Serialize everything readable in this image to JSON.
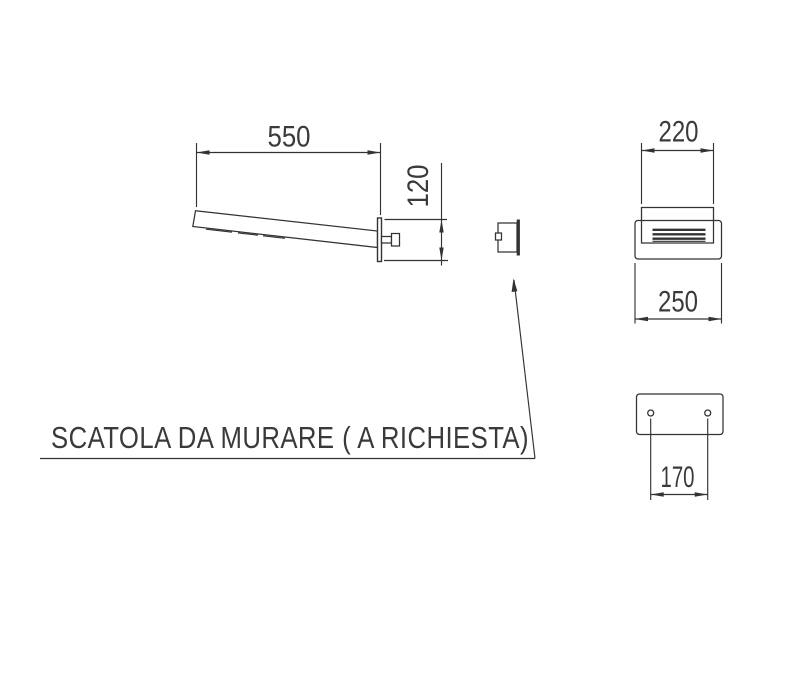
{
  "drawing": {
    "caption": "SCATOLA DA MURARE ( A RICHIESTA)",
    "dimensions": {
      "arm_length": "550",
      "backplate_height": "120",
      "head_width": "220",
      "body_width": "250",
      "hole_spacing": "170"
    },
    "colors": {
      "line": "#333333",
      "background": "#ffffff"
    }
  }
}
